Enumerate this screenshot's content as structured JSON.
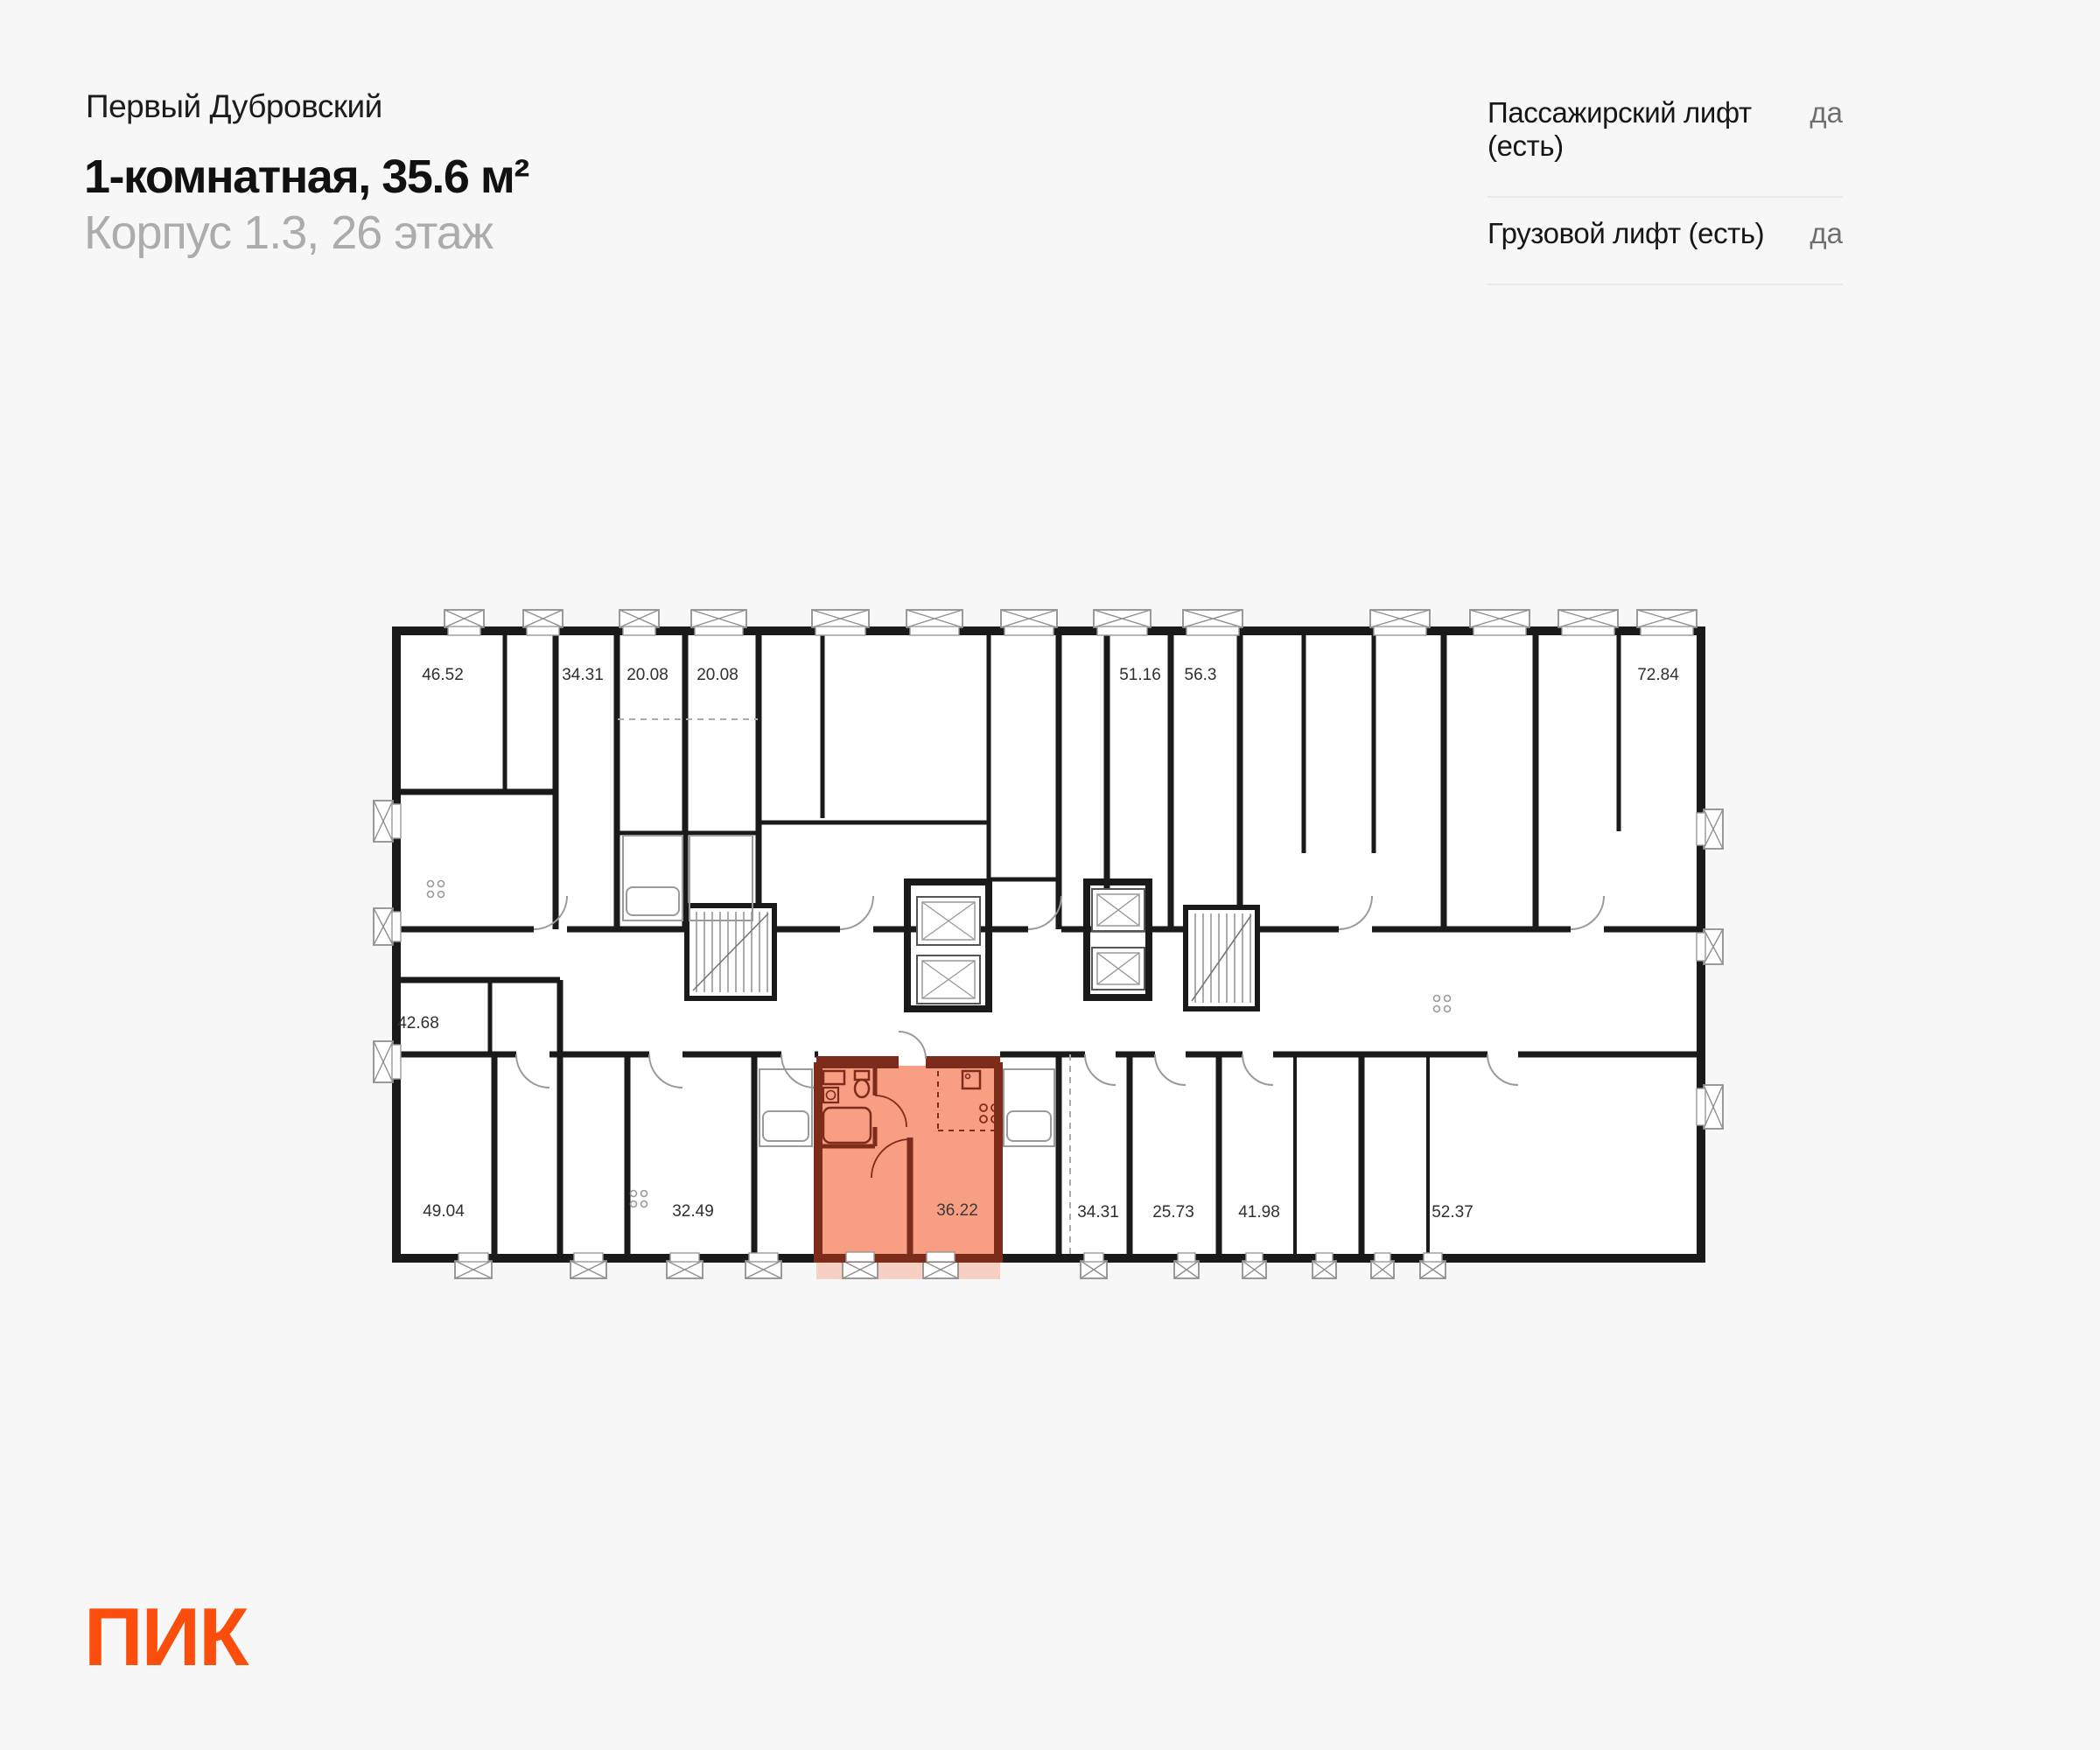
{
  "page": {
    "background": "#F7F7F7"
  },
  "header": {
    "project_name": "Первый Дубровский",
    "title": "1-комнатная, 35.6 м²",
    "subtitle": "Корпус 1.3, 26 этаж"
  },
  "info_panel": {
    "rows": [
      {
        "label": "Пассажирский лифт (есть)",
        "value": "да"
      },
      {
        "label": "Грузовой лифт (есть)",
        "value": "да"
      }
    ]
  },
  "floor_plan": {
    "colors": {
      "highlight_fill": "#F89E82",
      "highlight_wall": "#7D2B1B",
      "wall": "#1A1A1A"
    },
    "areas": [
      {
        "value": "46.52"
      },
      {
        "value": "34.31"
      },
      {
        "value": "20.08"
      },
      {
        "value": "20.08"
      },
      {
        "value": "51.16"
      },
      {
        "value": "56.3"
      },
      {
        "value": "72.84"
      },
      {
        "value": "42.68"
      },
      {
        "value": "49.04"
      },
      {
        "value": "32.49"
      },
      {
        "value": "36.22",
        "highlighted": true
      },
      {
        "value": "34.31"
      },
      {
        "value": "25.73"
      },
      {
        "value": "41.98"
      },
      {
        "value": "52.37"
      }
    ]
  },
  "footer": {
    "logo_text": "ПИК",
    "logo_color": "#FB4E0C"
  }
}
